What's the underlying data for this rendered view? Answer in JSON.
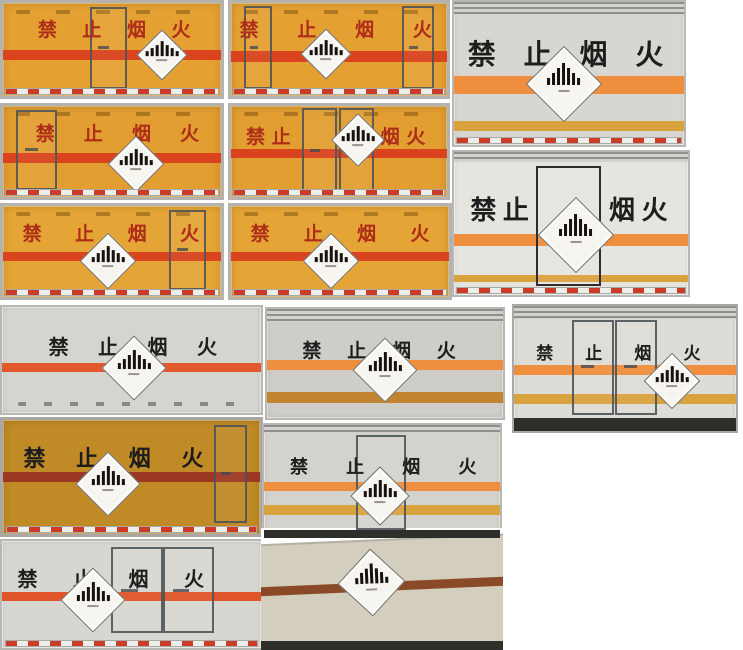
{
  "collage": {
    "subject": "禁止烟火",
    "photo_count": 15
  },
  "icons": {
    "hazard_placard": "hazard-diamond-icon"
  },
  "colors": {
    "yellow_box": "#e2a035",
    "red_stripe": "#d9431d",
    "red_text": "#ae2c18",
    "white_box": "#d8d6d0",
    "black_text": "#1e1e1e",
    "orange_stripe": "#ef8f3e",
    "gold_stripe": "#d8a23f",
    "amber_box": "#c08a26",
    "dark_red_stripe": "#9c3723",
    "beige_box": "#d3cebd",
    "brown_stripe": "#8a4a28",
    "placard_bg": "#f6f5f0",
    "placard_bars": "#17120e",
    "reflective_red": "#cc3a28",
    "reflective_white": "#eeeeea"
  },
  "tiles": {
    "a1": {
      "chars": [
        "禁",
        "止",
        "烟",
        "火"
      ]
    },
    "a2": {
      "chars": [
        "禁",
        "止",
        "烟",
        "火"
      ]
    },
    "a3": {
      "chars": [
        "禁",
        "止",
        "烟",
        "火"
      ]
    },
    "b1": {
      "chars": [
        "禁",
        "止",
        "烟",
        "火"
      ]
    },
    "b2": {
      "left_text": "禁 止",
      "right_text": "烟 火"
    },
    "d": {
      "left_text": "禁止",
      "right_text": "烟火"
    },
    "c1": {
      "chars": [
        "禁",
        "止",
        "烟",
        "火"
      ]
    },
    "c2": {
      "chars": [
        "禁",
        "止",
        "烟",
        "火"
      ]
    },
    "e1": {
      "chars": [
        "禁",
        "止",
        "烟",
        "火"
      ]
    },
    "e2": {
      "chars": [
        "禁",
        "止",
        "烟",
        "火"
      ]
    },
    "e3": {
      "chars": [
        "禁",
        "止",
        "烟",
        "火"
      ]
    },
    "f1": {
      "chars": [
        "禁",
        "止",
        "烟",
        "火"
      ]
    },
    "f2": {
      "chars": [
        "禁",
        "止",
        "烟",
        "火"
      ]
    },
    "g1": {
      "chars": [
        "禁",
        "止",
        "烟",
        "火"
      ]
    },
    "g2": {}
  }
}
